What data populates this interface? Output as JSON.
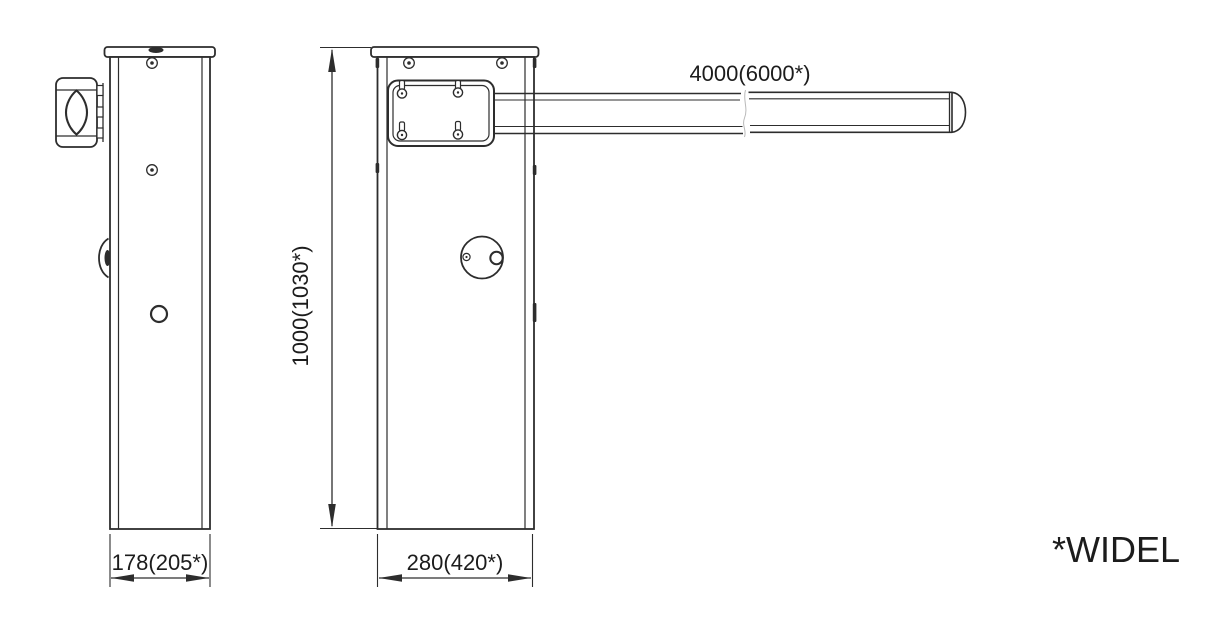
{
  "drawing": {
    "title": "barrier-gate-dimension-drawing",
    "footnote": "*WIDEL",
    "colors": {
      "line": "#2d2d2d",
      "text": "#1c1c1c",
      "background": "#ffffff"
    },
    "dimensions": {
      "boom_length": {
        "label": "4000(6000*)",
        "standard_mm": 4000,
        "optional_mm": 6000
      },
      "cabinet_height": {
        "label": "1000(1030*)",
        "standard_mm": 1000,
        "optional_mm": 1030
      },
      "cabinet_depth": {
        "label": "178(205*)",
        "standard_mm": 178,
        "optional_mm": 205
      },
      "cabinet_width": {
        "label": "280(420*)",
        "standard_mm": 280,
        "optional_mm": 420
      }
    },
    "views": {
      "side_view": "cabinet side view with boom bracket",
      "front_view": "cabinet front view with boom arm"
    }
  }
}
